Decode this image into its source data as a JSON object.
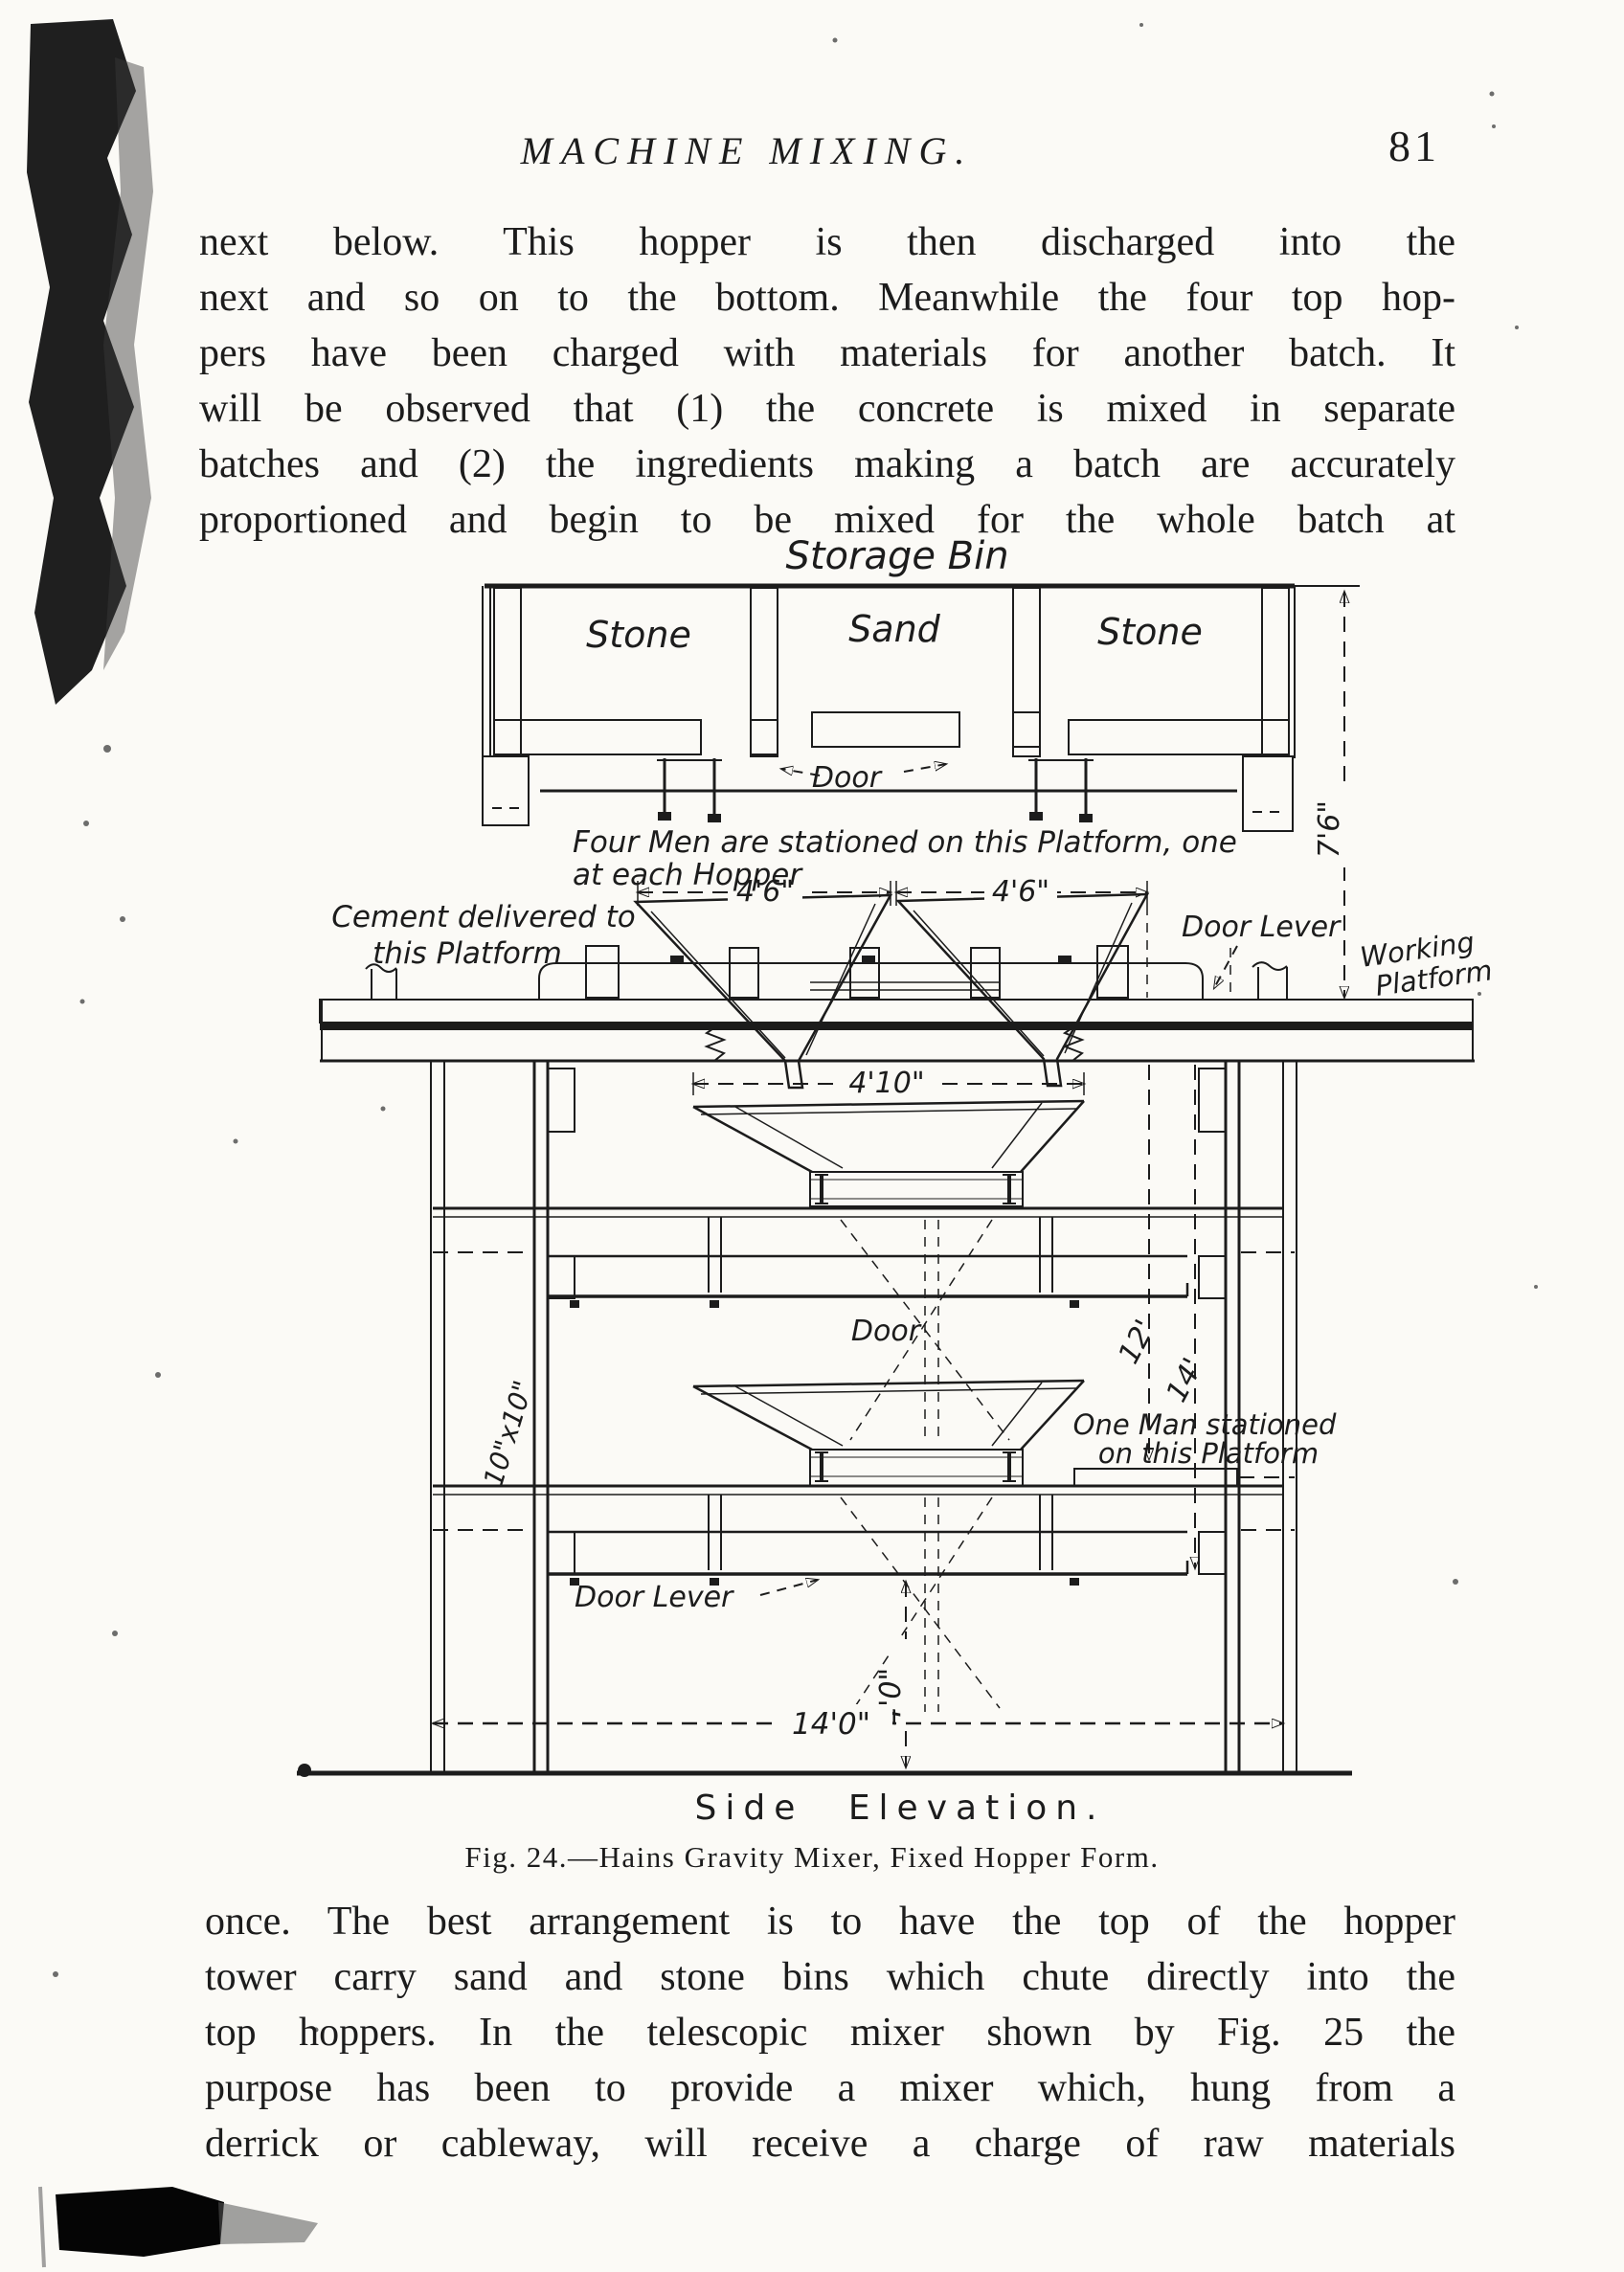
{
  "page": {
    "colors": {
      "ink": "#1c1c1c",
      "paper": "#fbfaf6"
    },
    "header": {
      "title": "MACHINE MIXING.",
      "page_number": "81"
    },
    "paragraph_top": {
      "lines": [
        "next below.  This hopper is then discharged into the",
        "next and so on to the bottom.  Meanwhile the four top hop-",
        "pers have been charged with materials for another batch.  It",
        "will be observed that (1) the concrete is mixed in separate",
        "batches and (2) the ingredients making a batch are accurately",
        "proportioned and begin to be mixed for the whole batch at"
      ]
    },
    "figure": {
      "storage_bin": {
        "title": "Storage Bin",
        "compartments": [
          "Stone",
          "Sand",
          "Stone"
        ],
        "door_label": "Door"
      },
      "annotations": {
        "four_men_line1": "Four Men are stationed on this Platform, one",
        "four_men_line2": "at each Hopper",
        "cement_line1": "Cement delivered to",
        "cement_line2": "this Platform",
        "door_lever_upper": "Door Lever",
        "working_line1": "Working",
        "working_line2": "Platform",
        "door_mid": "Door",
        "one_man_line1": "One Man stationed",
        "one_man_line2": "on this Platform",
        "door_lever_lower": "Door Lever"
      },
      "dimensions": {
        "bin_height": "7'6\"",
        "hopper_width_left": "4'6\"",
        "hopper_width_right": "4'6\"",
        "inner_hopper_width": "4'10\"",
        "post_section": "10\"x10\"",
        "height_to_lower_door": "12'",
        "height_to_bottom_door": "14'",
        "discharge_height": "4'0\"",
        "base_width": "14'0\""
      },
      "view_label": "Side Elevation.",
      "caption": "Fig. 24.—Hains Gravity Mixer, Fixed Hopper Form."
    },
    "paragraph_bottom": {
      "lines": [
        "once.  The best arrangement is to have the top of the hopper",
        "tower carry sand and stone bins which chute directly into the",
        "top hoppers.  In the telescopic mixer shown by Fig. 25 the",
        "purpose has been to provide a mixer which, hung from a",
        "derrick or cableway, will receive a charge of raw materials"
      ]
    }
  }
}
